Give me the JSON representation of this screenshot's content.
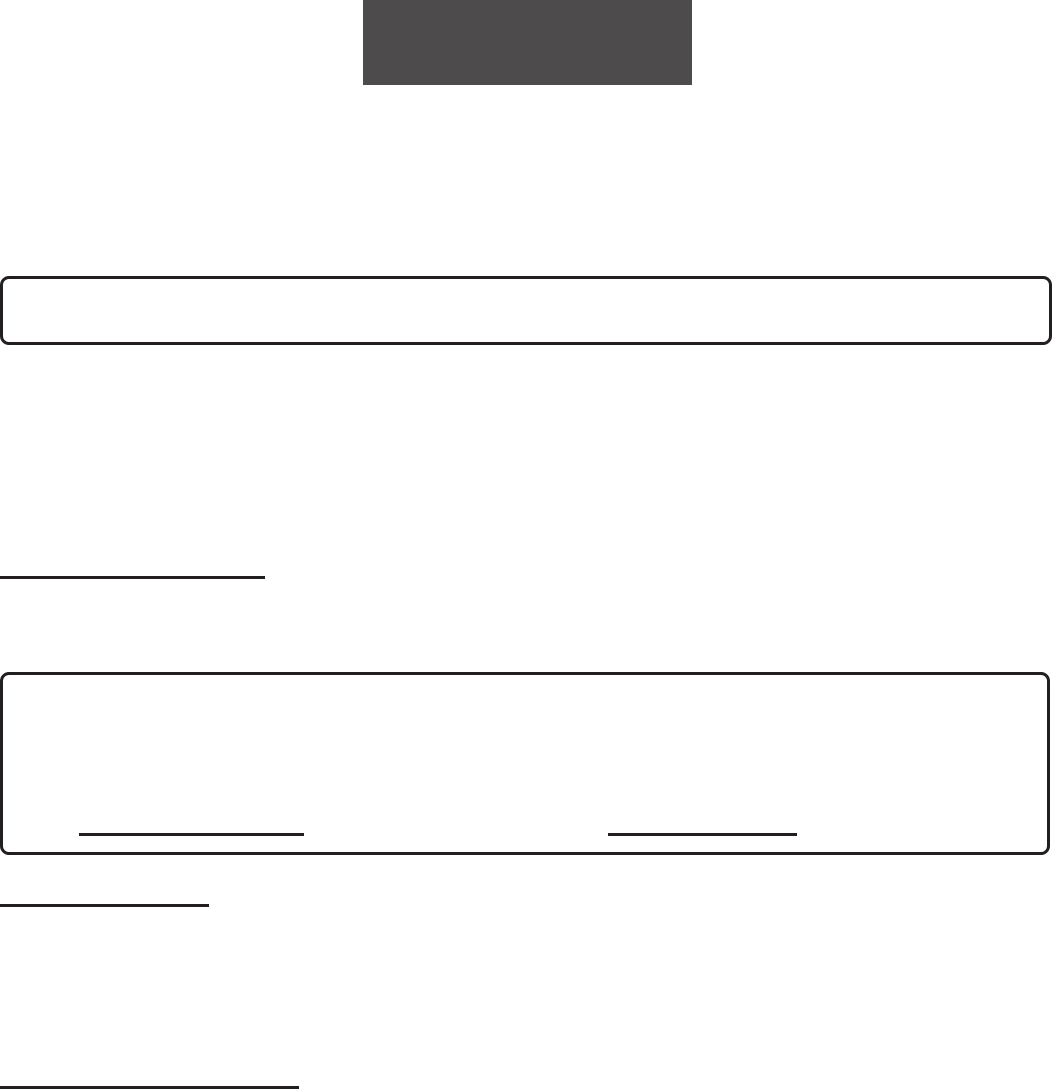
{
  "document": {
    "background_color": "#ffffff",
    "redaction_block": {
      "color": "#4d4b4c"
    },
    "box_border_color": "#231f20",
    "rule_color": "#231f20",
    "text": {}
  }
}
